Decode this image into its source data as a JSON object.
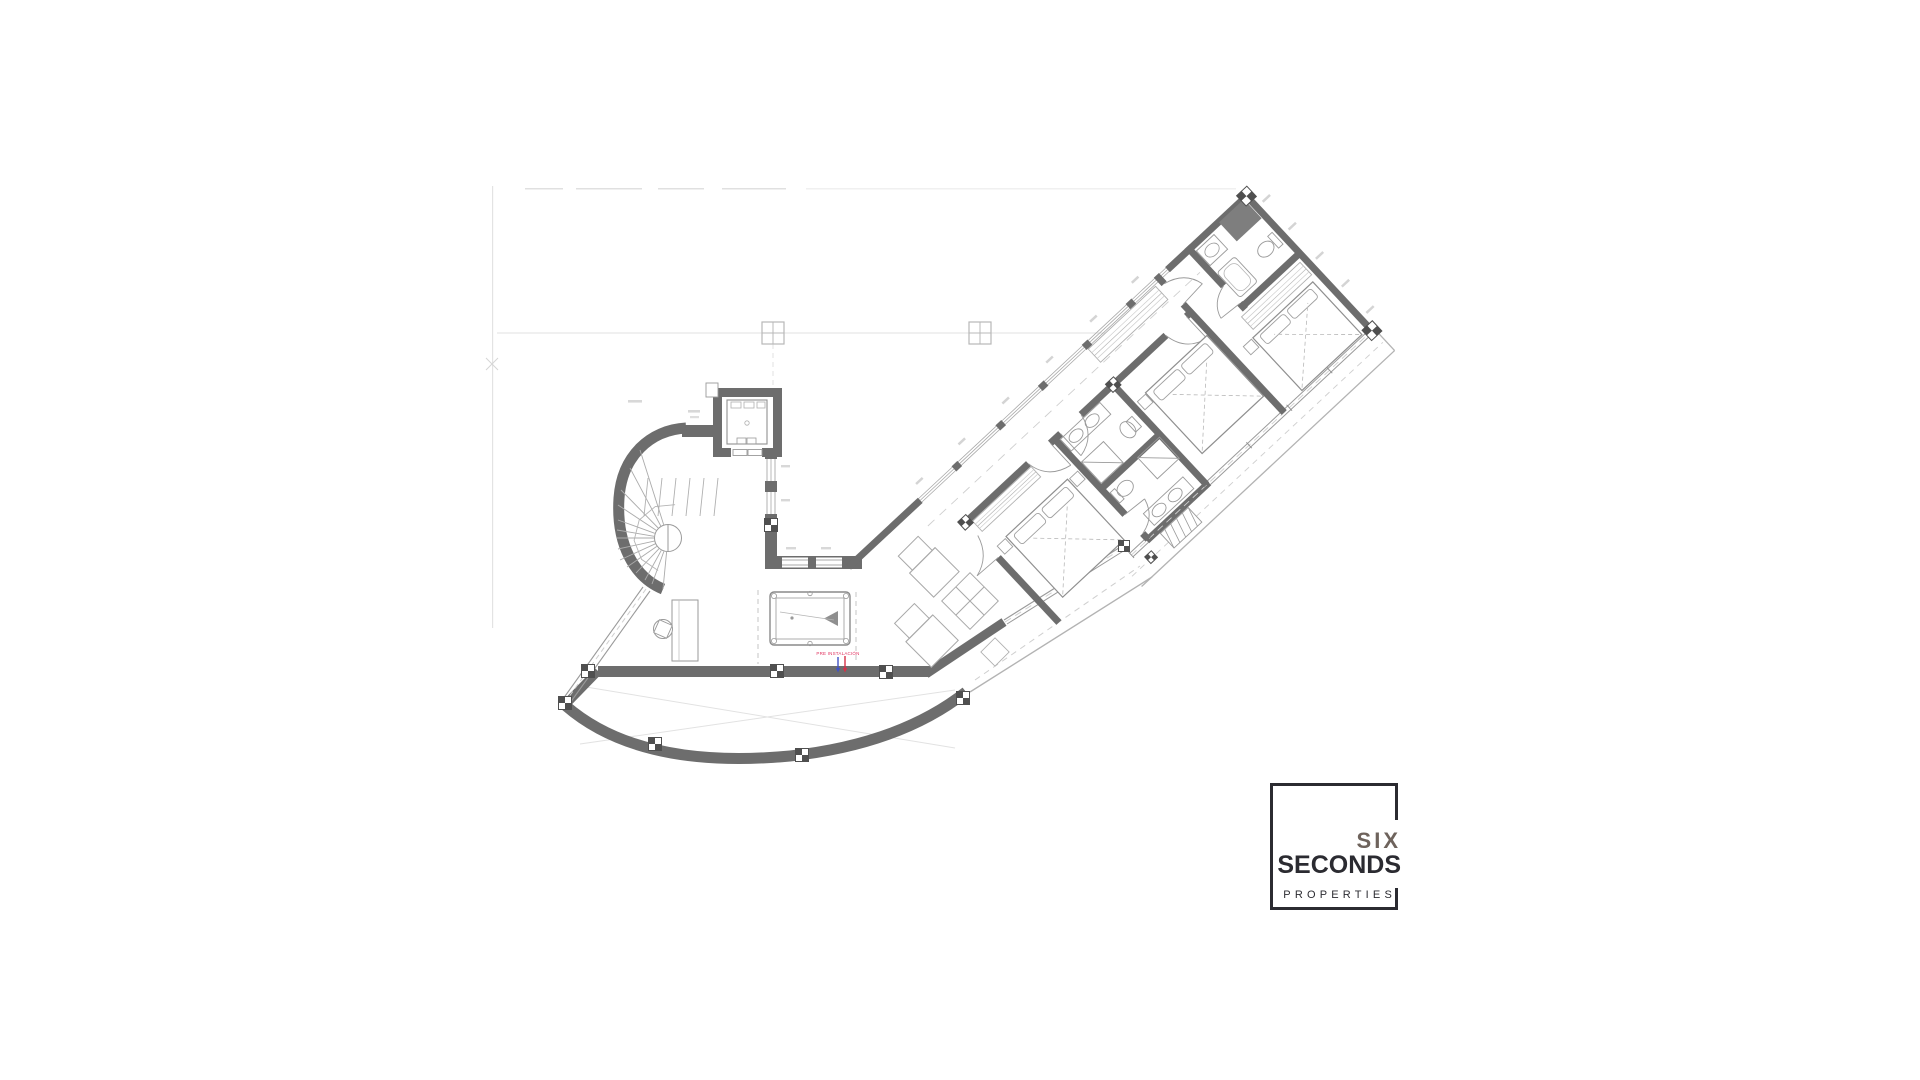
{
  "canvas": {
    "width": 1920,
    "height": 1080,
    "background": "#ffffff"
  },
  "plan": {
    "colors": {
      "wall": "#6d6d6d",
      "column_checker": "#4f4f4f",
      "line_medium": "#9a9a9a",
      "line_light": "#b5b5b5",
      "line_faint": "#e3e3e3"
    },
    "annotation": {
      "text": "PRE INSTALACIÓN",
      "color": "#e0315e",
      "arrow_left_color": "#4153c6",
      "arrow_right_color": "#d63048"
    }
  },
  "logo": {
    "top_word": "SIX",
    "main_word": "SECONDS",
    "sub_word": "PROPERTIES",
    "frame_color": "#2b2b31",
    "top_word_color": "#6e635c",
    "main_word_color": "#2b2b31"
  }
}
